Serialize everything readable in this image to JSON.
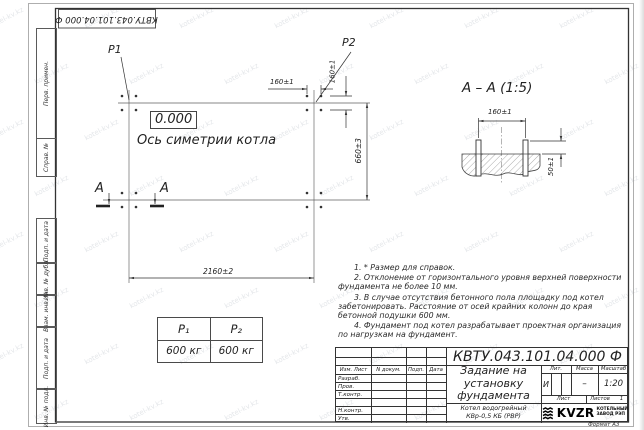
{
  "doc": {
    "number": "КВТУ.043.101.04.000  Ф",
    "format_note": "Формат А3"
  },
  "margins": {
    "strip": [
      "Перв. примен.",
      "Справ. №",
      "Подп. и дата",
      "Инв. № дубл.",
      "Взам. инв. №",
      "Подп. и дата",
      "Инв. № подл."
    ]
  },
  "plan": {
    "p1": "P1",
    "p2": "P2",
    "elevation": "0.000",
    "axis_label": "Ось симетрии котла",
    "dim_width": "2160±2",
    "dim_height": "660±3",
    "dim_bolt_x": "160±1",
    "dim_bolt_y": "160±1",
    "section_letter": "А"
  },
  "section": {
    "title": "А – А (1:5)",
    "dim_spacing": "160±1",
    "dim_height": "50±1"
  },
  "load_table": {
    "headers": [
      "P₁",
      "P₂"
    ],
    "values": [
      "600 кг",
      "600 кг"
    ]
  },
  "notes": {
    "lines": [
      "1. * Размер для справок.",
      "2. Отклонение от горизонтального уровня верхней поверхности фундамента не более 10 мм.",
      "3. В случае отсутствия бетонного пола площадку под котел забетонировать. Расстояние от осей крайних колонн до края бетонной подушки 600 мм.",
      "4. Фундамент под котел разрабатывает проектная организация по нагрузкам на фундамент."
    ]
  },
  "title_block": {
    "header_cols": [
      "Изм. Лист",
      "N докум.",
      "Подп.",
      "Дата"
    ],
    "rows": [
      "Разраб.",
      "Пров.",
      "Т.контр.",
      "",
      "Н.контр.",
      "Утв."
    ],
    "title_lines": [
      "Задание на",
      "установку",
      "фундамента"
    ],
    "product_lines": [
      "Котел водогрейный",
      "КВр-0,5 КБ  (РВР)"
    ],
    "lit_label": "Лит.",
    "mass_label": "Масса",
    "scale_label": "Масштаб",
    "lit_value": "И",
    "mass_value": "–",
    "scale_value": "1:20",
    "sheet_label": "Лист",
    "sheets_label": "Листов",
    "sheets_value": "1",
    "brand": "KVZR",
    "brand_line1": "КОТЕЛЬНЫЙ",
    "brand_line2": "ЗАВОД РЭП"
  },
  "watermark": {
    "text": "kotel-kv.kz"
  }
}
